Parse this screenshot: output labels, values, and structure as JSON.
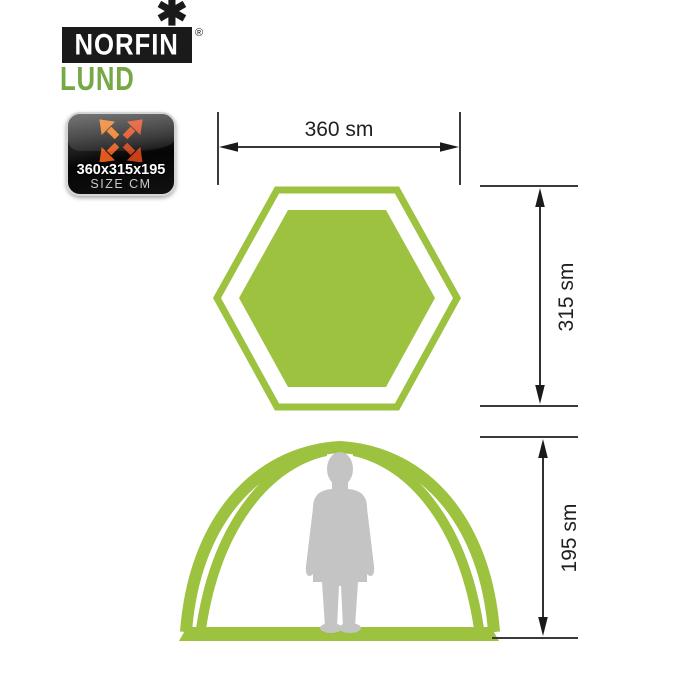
{
  "brand": {
    "logo_text": "NORFIN",
    "registered_mark": "®",
    "snowflake": "✱",
    "model_name": "LUND"
  },
  "size_badge": {
    "dimensions_text": "360x315x195",
    "caption": "SIZE CM"
  },
  "dimensions": {
    "width_label": "360 sm",
    "depth_label": "315 sm",
    "height_label": "195 sm"
  },
  "colors": {
    "tent_green": "#9cc23f",
    "brand_green": "#76a845",
    "logo_black": "#1a1a1a",
    "person_gray": "#c4c4c4",
    "dimension_line": "#3a3a3a",
    "badge_border": "#d5d5d5",
    "badge_arrow_top_left": "#ee7a1e",
    "badge_arrow_top_right": "#e1491c",
    "badge_arrow_bottom_left": "#e05a1d",
    "badge_arrow_bottom_right": "#c64117"
  }
}
